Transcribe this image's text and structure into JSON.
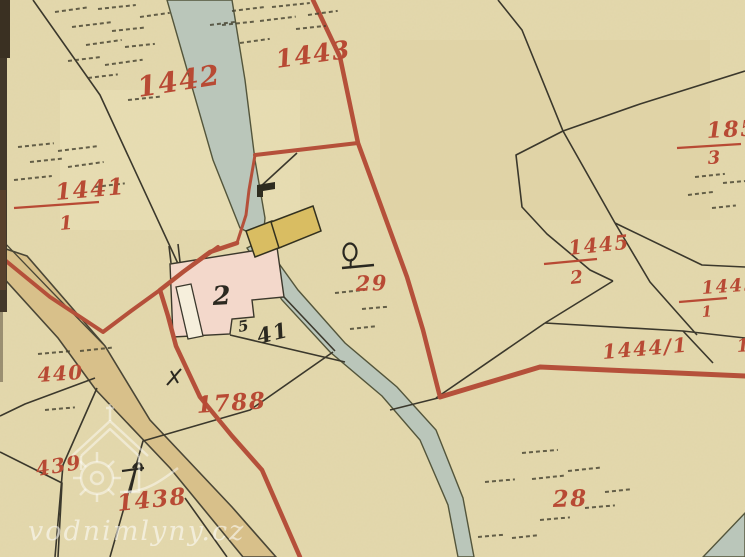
{
  "map": {
    "title": "historical cadastral map sheet",
    "watermark": {
      "text": "vodnimlyny.cz",
      "logo": "watermill-house-logo"
    },
    "colors": {
      "paper": "#e7dcb0",
      "red_ink": "#b5503a",
      "label_red": "#b84a34",
      "label_black": "#2b2920",
      "stream_fill": "#bac6ba",
      "road_fill": "#d8c08a",
      "building_pink": "#f3d8cb",
      "building_yellow": "#d9bd62",
      "line_black": "#3b382c",
      "sheet_edge": "#42382a"
    },
    "labels": [
      {
        "id": "parcel-1442",
        "text": "1442",
        "x": 139,
        "y": 97,
        "size": 28,
        "rot": -9,
        "color": "red"
      },
      {
        "id": "parcel-1443",
        "text": "1443",
        "x": 277,
        "y": 68,
        "size": 25,
        "rot": -8,
        "color": "red"
      },
      {
        "id": "parcel-1441-num",
        "text": "1441",
        "x": 56,
        "y": 200,
        "size": 23,
        "rot": -5,
        "color": "red",
        "underline": [
          14,
          208,
          99,
          202
        ]
      },
      {
        "id": "parcel-1441-den",
        "text": "1",
        "x": 60,
        "y": 230,
        "size": 19,
        "rot": -5,
        "color": "red"
      },
      {
        "id": "parcel-185-num",
        "text": "185",
        "x": 707,
        "y": 138,
        "size": 22,
        "rot": -3,
        "color": "red",
        "underline": [
          677,
          148,
          741,
          144
        ]
      },
      {
        "id": "parcel-185-den",
        "text": "3",
        "x": 708,
        "y": 164,
        "size": 18,
        "rot": -3,
        "color": "red"
      },
      {
        "id": "parcel-1445-2-num",
        "text": "1445",
        "x": 569,
        "y": 255,
        "size": 20,
        "rot": -6,
        "color": "red",
        "underline": [
          544,
          264,
          597,
          259
        ]
      },
      {
        "id": "parcel-1445-2-den",
        "text": "2",
        "x": 571,
        "y": 284,
        "size": 18,
        "rot": -6,
        "color": "red"
      },
      {
        "id": "parcel-1445-1-num",
        "text": "1445",
        "x": 702,
        "y": 294,
        "size": 18,
        "rot": -4,
        "color": "red",
        "underline": [
          679,
          302,
          727,
          298
        ]
      },
      {
        "id": "parcel-1445-1-den",
        "text": "1",
        "x": 702,
        "y": 317,
        "size": 15,
        "rot": -4,
        "color": "red"
      },
      {
        "id": "parcel-1444-1",
        "text": "1444/1",
        "x": 603,
        "y": 359,
        "size": 20,
        "rot": -5,
        "color": "red"
      },
      {
        "id": "parcel-14-clipped",
        "text": "14",
        "x": 737,
        "y": 352,
        "size": 18,
        "rot": -4,
        "color": "red"
      },
      {
        "id": "parcel-29",
        "text": "29",
        "x": 356,
        "y": 291,
        "size": 21,
        "rot": -2,
        "color": "red"
      },
      {
        "id": "parcel-28",
        "text": "28",
        "x": 553,
        "y": 507,
        "size": 23,
        "rot": -2,
        "color": "red"
      },
      {
        "id": "parcel-440",
        "text": "440",
        "x": 38,
        "y": 382,
        "size": 20,
        "rot": -4,
        "color": "red"
      },
      {
        "id": "parcel-439",
        "text": "439",
        "x": 37,
        "y": 476,
        "size": 20,
        "rot": -9,
        "color": "red"
      },
      {
        "id": "parcel-1438",
        "text": "1438",
        "x": 118,
        "y": 511,
        "size": 23,
        "rot": -6,
        "color": "red"
      },
      {
        "id": "parcel-1788",
        "text": "1788",
        "x": 197,
        "y": 413,
        "size": 23,
        "rot": -4,
        "color": "red"
      },
      {
        "id": "house-number-2",
        "text": "2",
        "x": 213,
        "y": 305,
        "size": 26,
        "rot": -3,
        "color": "black"
      },
      {
        "id": "house-number-41",
        "text": "41",
        "x": 259,
        "y": 344,
        "size": 21,
        "rot": -14,
        "color": "black"
      },
      {
        "id": "house-number-5",
        "text": "5",
        "x": 239,
        "y": 332,
        "size": 15,
        "rot": -10,
        "color": "black"
      }
    ],
    "hatches": [
      [
        55,
        12,
        34,
        -8
      ],
      [
        98,
        9,
        38,
        -6
      ],
      [
        140,
        17,
        30,
        -8
      ],
      [
        72,
        27,
        40,
        -7
      ],
      [
        112,
        31,
        34,
        -6
      ],
      [
        86,
        45,
        36,
        -8
      ],
      [
        125,
        47,
        30,
        -6
      ],
      [
        68,
        61,
        34,
        -7
      ],
      [
        105,
        65,
        38,
        -8
      ],
      [
        88,
        78,
        30,
        -7
      ],
      [
        128,
        100,
        34,
        -6
      ],
      [
        18,
        147,
        36,
        -6
      ],
      [
        58,
        151,
        40,
        -7
      ],
      [
        30,
        162,
        34,
        -6
      ],
      [
        68,
        167,
        36,
        -8
      ],
      [
        14,
        180,
        38,
        -6
      ],
      [
        95,
        187,
        30,
        -7
      ],
      [
        232,
        11,
        34,
        -7
      ],
      [
        272,
        7,
        38,
        -6
      ],
      [
        308,
        15,
        30,
        -8
      ],
      [
        222,
        25,
        34,
        -6
      ],
      [
        260,
        21,
        36,
        -7
      ],
      [
        296,
        29,
        30,
        -6
      ],
      [
        240,
        43,
        30,
        -8
      ],
      [
        210,
        25,
        26,
        -7
      ],
      [
        695,
        177,
        30,
        -6
      ],
      [
        723,
        183,
        26,
        -5
      ],
      [
        688,
        195,
        28,
        -7
      ],
      [
        712,
        208,
        24,
        -6
      ],
      [
        335,
        293,
        30,
        -6
      ],
      [
        362,
        309,
        28,
        -5
      ],
      [
        350,
        329,
        26,
        -6
      ],
      [
        38,
        354,
        32,
        -5
      ],
      [
        80,
        351,
        34,
        -6
      ],
      [
        45,
        410,
        30,
        -5
      ],
      [
        522,
        453,
        36,
        -5
      ],
      [
        568,
        471,
        34,
        -6
      ],
      [
        485,
        482,
        30,
        -5
      ],
      [
        532,
        479,
        32,
        -6
      ],
      [
        540,
        520,
        30,
        -5
      ],
      [
        512,
        538,
        28,
        -6
      ],
      [
        585,
        508,
        30,
        -5
      ],
      [
        478,
        537,
        28,
        -5
      ],
      [
        605,
        492,
        26,
        -6
      ]
    ]
  }
}
